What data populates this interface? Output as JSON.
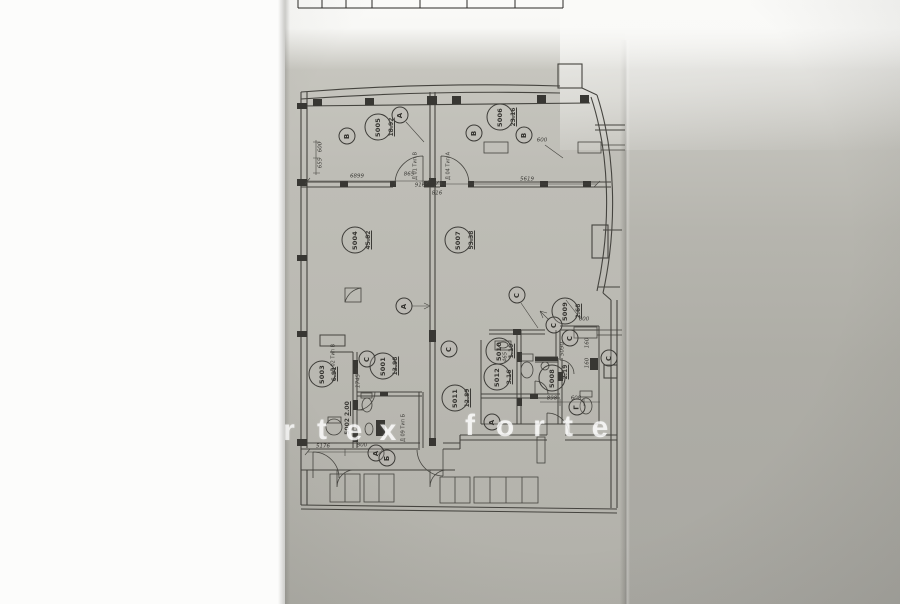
{
  "colors": {
    "paper": "#bab9b2",
    "photo_background": "#aaa9a3",
    "ink": "#44433f",
    "white_page": "#fbfbf9",
    "watermark": "#ffffff"
  },
  "watermark": {
    "letters": [
      "r",
      "t",
      "e",
      "x",
      "f",
      "o",
      "r",
      "t",
      "e"
    ]
  },
  "plan": {
    "rooms": [
      {
        "id": "5001",
        "area": "13.98"
      },
      {
        "id": "5002",
        "area": "2.00"
      },
      {
        "id": "5003",
        "area": "6.91"
      },
      {
        "id": "5004",
        "area": "45.82"
      },
      {
        "id": "5005",
        "area": "18.92"
      },
      {
        "id": "5006",
        "area": "23.16"
      },
      {
        "id": "5007",
        "area": "53.38"
      },
      {
        "id": "5008",
        "area": "2.19"
      },
      {
        "id": "5009",
        "area": "2.68"
      },
      {
        "id": "5010",
        "area": "1.19"
      },
      {
        "id": "5011",
        "area": "12.89"
      },
      {
        "id": "5012",
        "area": "3.16"
      }
    ],
    "markers": [
      "В",
      "А",
      "В",
      "В",
      "А",
      "С",
      "С",
      "С",
      "С",
      "С",
      "С",
      "Г",
      "А",
      "Б",
      "А"
    ],
    "door_labels": [
      "Д 01 Тип В",
      "Д 04 Тип А",
      "Д 02 Тип В",
      "Д 09 Тип Б"
    ],
    "dimensions": [
      "6899",
      "865",
      "916",
      "816",
      "5619",
      "600",
      "655",
      "600",
      "5176",
      "800",
      "1745",
      "5090",
      "160",
      "160",
      "465",
      "898",
      "608",
      "600"
    ]
  }
}
